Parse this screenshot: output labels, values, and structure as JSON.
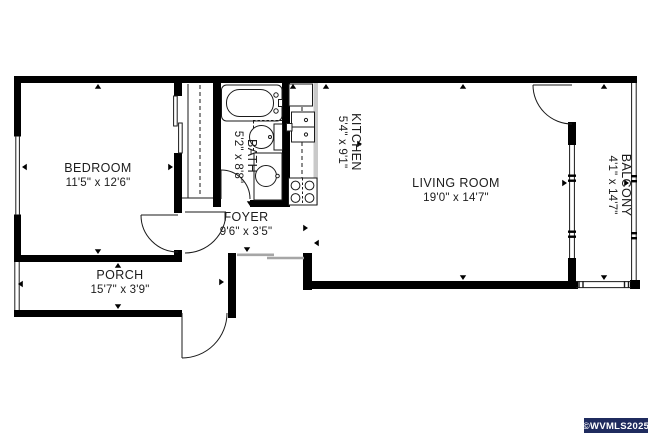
{
  "rooms": {
    "bedroom": {
      "name": "BEDROOM",
      "dims": "11'5\" x 12'6\""
    },
    "bath": {
      "name": "BATH",
      "dims": "5'2\" x 8'8\""
    },
    "kitchen": {
      "name": "KITCHEN",
      "dims": "5'4\" x 9'1\""
    },
    "living_room": {
      "name": "LIVING ROOM",
      "dims": "19'0\" x 14'7\""
    },
    "foyer": {
      "name": "FOYER",
      "dims": "9'6\" x 3'5\""
    },
    "porch": {
      "name": "PORCH",
      "dims": "15'7\" x 3'9\""
    },
    "balcony": {
      "name": "BALCONY",
      "dims": "4'1\" x 14'7\""
    }
  },
  "watermark": {
    "text": "©WVMLS2025",
    "bg_color": "#1f2b5e",
    "text_color": "#ffffff"
  },
  "colors": {
    "wall": "#000000",
    "line": "#1a1a1a",
    "counter_fill": "#c9c9c9",
    "window_line": "#a6a6a6",
    "background": "#ffffff"
  }
}
